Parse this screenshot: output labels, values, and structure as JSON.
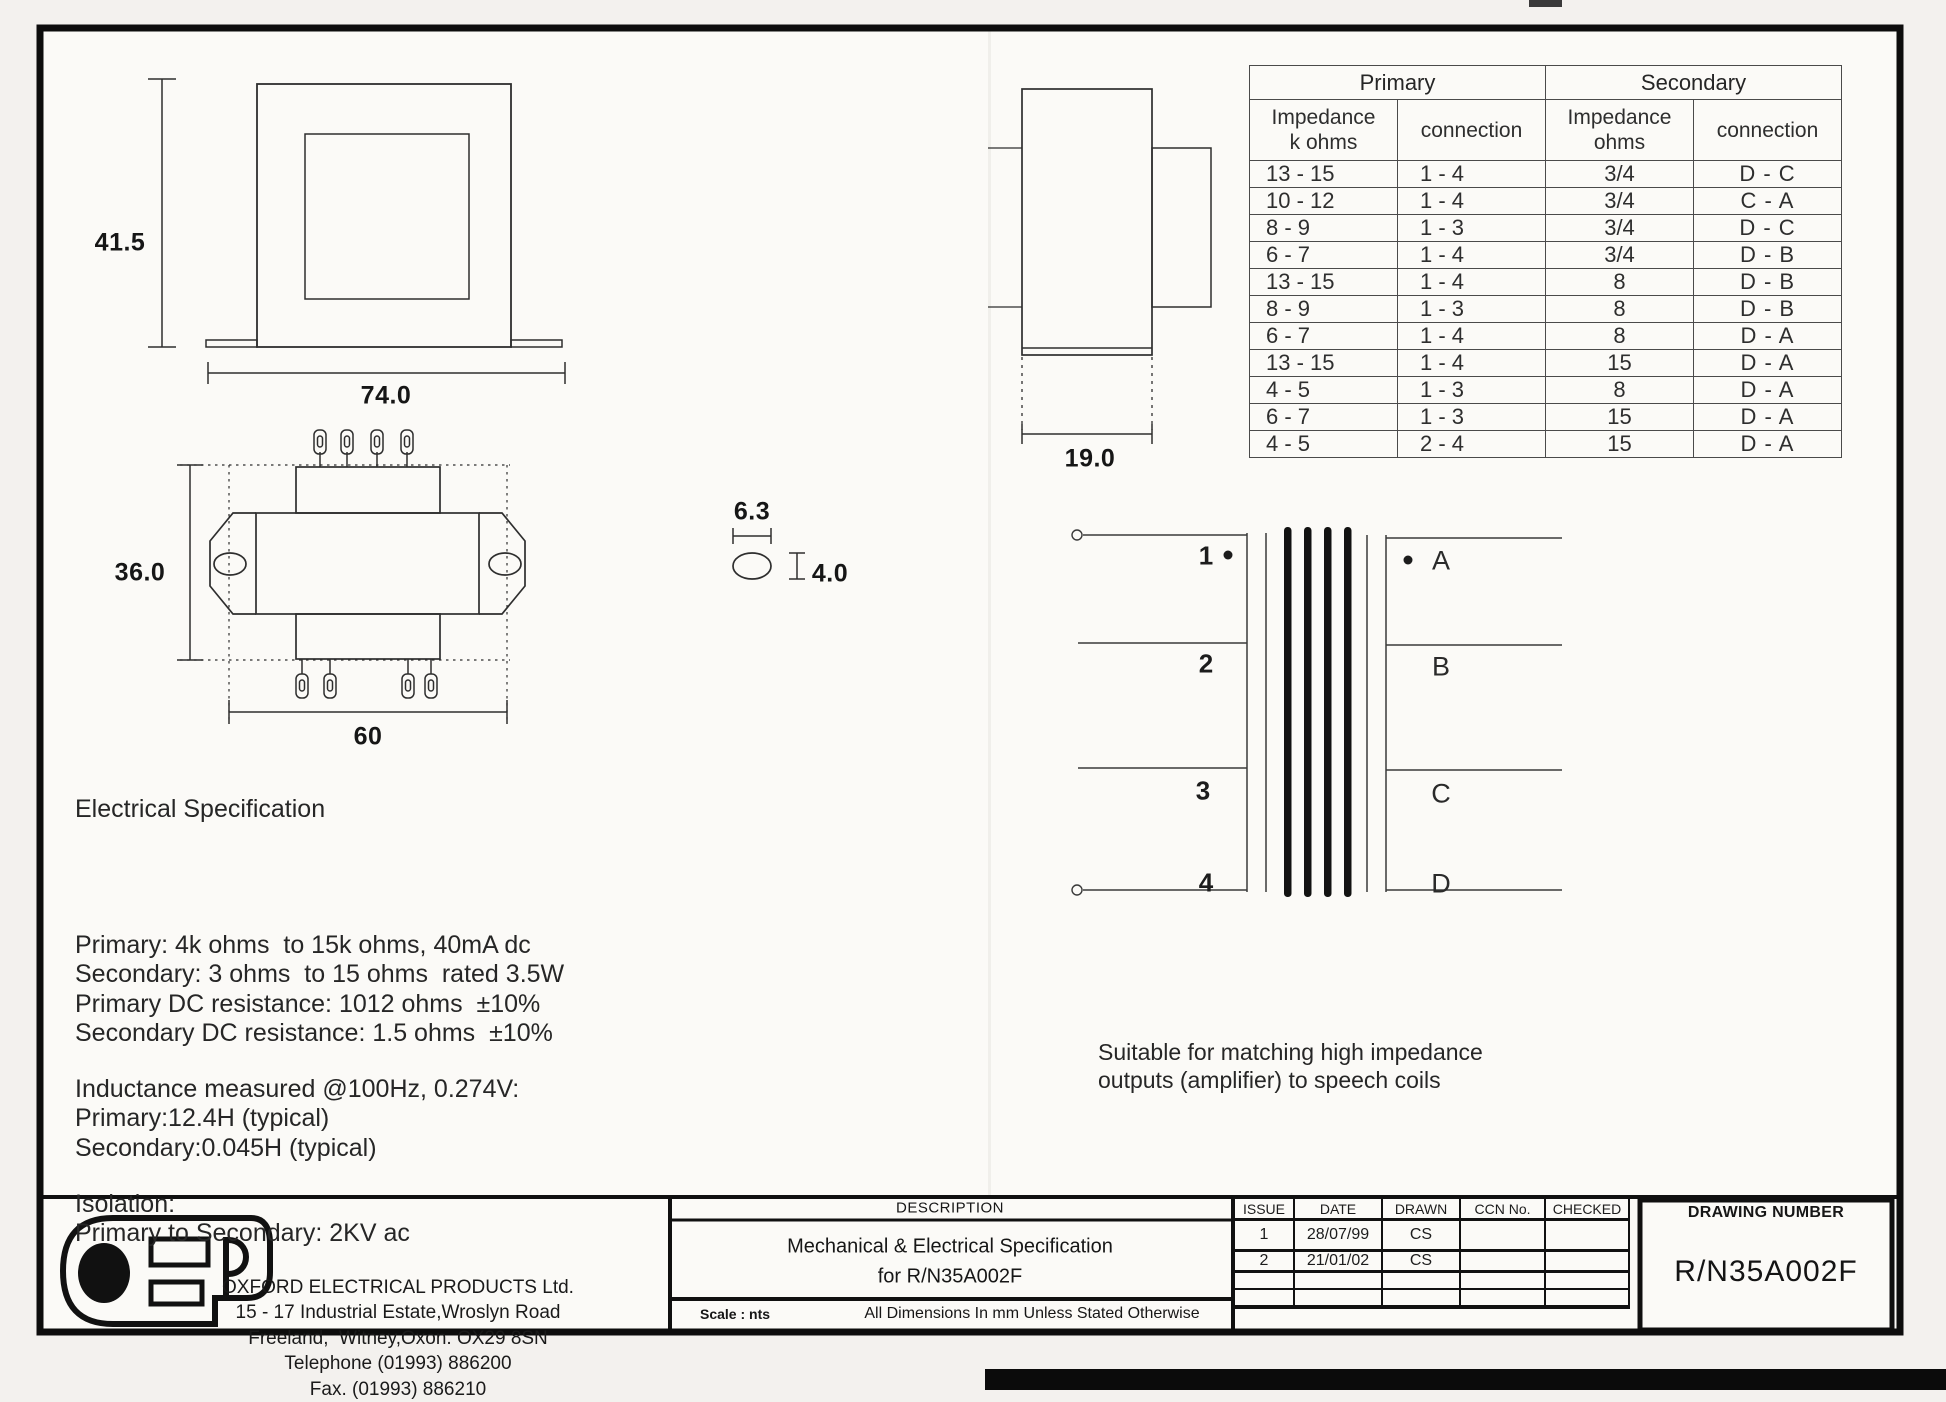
{
  "impedance_table": {
    "group_headers": [
      "Primary",
      "Secondary"
    ],
    "col_headers": [
      "Impedance\nk ohms",
      "connection",
      "Impedance\nohms",
      "connection"
    ],
    "rows": [
      [
        "13 - 15",
        "1 - 4",
        "3/4",
        "D - C"
      ],
      [
        "10 - 12",
        "1 - 4",
        "3/4",
        "C - A"
      ],
      [
        "8 - 9",
        "1 - 3",
        "3/4",
        "D - C"
      ],
      [
        "6 - 7",
        "1 - 4",
        "3/4",
        "D - B"
      ],
      [
        "13 - 15",
        "1 - 4",
        "8",
        "D - B"
      ],
      [
        "8 - 9",
        "1 - 3",
        "8",
        "D - B"
      ],
      [
        "6 - 7",
        "1 - 4",
        "8",
        "D - A"
      ],
      [
        "13 - 15",
        "1 - 4",
        "15",
        "D - A"
      ],
      [
        "4 - 5",
        "1 - 3",
        "8",
        "D - A"
      ],
      [
        "6 - 7",
        "1 - 3",
        "15",
        "D - A"
      ],
      [
        "4 - 5",
        "2 - 4",
        "15",
        "D - A"
      ]
    ]
  },
  "dimensions": {
    "front_height": "41.5",
    "front_width": "74.0",
    "top_height": "36.0",
    "top_width": "60",
    "slot_width": "6.3",
    "slot_height": "4.0",
    "side_width": "19.0"
  },
  "winding_diagram": {
    "primary_terminals": [
      "1",
      "2",
      "3",
      "4"
    ],
    "secondary_terminals": [
      "A",
      "B",
      "C",
      "D"
    ],
    "note_lines": [
      "Suitable for matching high impedance",
      "outputs (amplifier) to speech coils"
    ]
  },
  "electrical_spec": {
    "title": "Electrical Specification",
    "block1": [
      "Primary: 4k ohms  to 15k ohms, 40mA dc",
      "Secondary: 3 ohms  to 15 ohms  rated 3.5W",
      "Primary DC resistance: 1012 ohms  ±10%",
      "Secondary DC resistance: 1.5 ohms  ±10%"
    ],
    "block2": [
      "Inductance measured @100Hz, 0.274V:",
      "Primary:12.4H (typical)",
      "Secondary:0.045H (typical)"
    ],
    "block3": [
      "Isolation:",
      "Primary to Secondary: 2KV ac"
    ]
  },
  "title_block": {
    "company_lines": [
      "OXFORD ELECTRICAL PRODUCTS Ltd.",
      "15 - 17 Industrial Estate,Wroslyn Road",
      "Freeland,  Witney,Oxon. OX29 8SN",
      "Telephone (01993) 886200",
      "Fax. (01993) 886210"
    ],
    "description_label": "DESCRIPTION",
    "description_lines": [
      "Mechanical & Electrical Specification",
      "for R/N35A002F"
    ],
    "scale_label": "Scale : nts",
    "dimensions_note": "All Dimensions In mm Unless Stated Otherwise",
    "issue_table": {
      "headers": [
        "ISSUE",
        "DATE",
        "DRAWN",
        "CCN No.",
        "CHECKED"
      ],
      "rows": [
        [
          "1",
          "28/07/99",
          "CS",
          "",
          ""
        ],
        [
          "2",
          "21/01/02",
          "CS",
          "",
          ""
        ],
        [
          "",
          "",
          "",
          "",
          ""
        ],
        [
          "",
          "",
          "",
          "",
          ""
        ],
        [
          "",
          "",
          "",
          "",
          ""
        ]
      ]
    },
    "drawing_number_label": "DRAWING NUMBER",
    "drawing_number": "R/N35A002F"
  }
}
